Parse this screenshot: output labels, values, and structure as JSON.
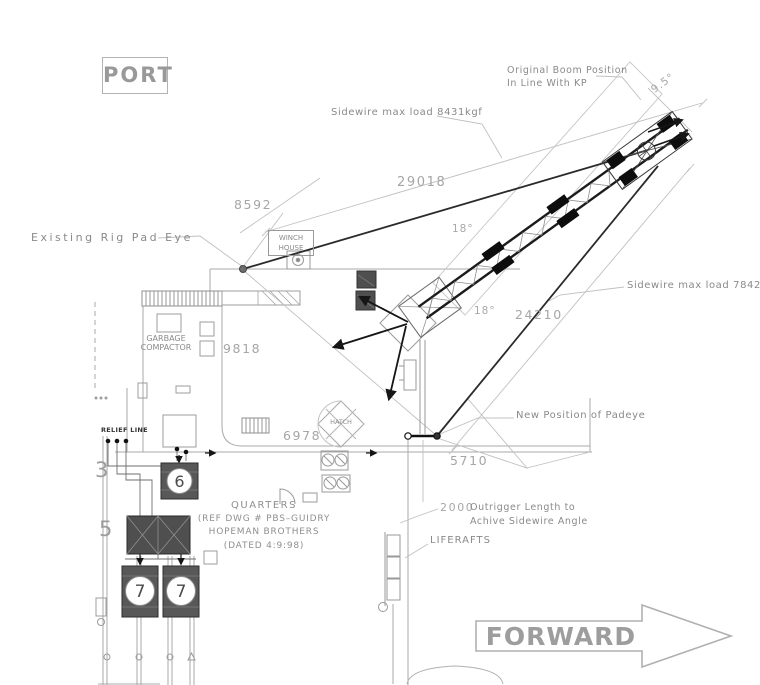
{
  "title": "Deck plan — crane boom and sidewire rigging arrangement",
  "orientation": {
    "port": "PORT",
    "forward": "FORWARD"
  },
  "labels": {
    "original_boom_line1": "Original Boom Position",
    "original_boom_line2": "In Line With KP",
    "sidewire_upper": "Sidewire max load 8431kgf",
    "sidewire_lower": "Sidewire max load 7842kgf",
    "existing_pad_eye": "Existing Rig Pad Eye",
    "new_padeye": "New Position of Padeye",
    "winch_line1": "WINCH",
    "winch_line2": "HOUSE",
    "garbage_line1": "GARBAGE",
    "garbage_line2": "COMPACTOR",
    "hatch": "HATCH",
    "liferafts": "LIFERAFTS",
    "relief_line": "RELIEF LINE",
    "quarters_line1": "QUARTERS",
    "quarters_line2": "(REF  DWG  #  PBS–GUIDRY",
    "quarters_line3": "HOPEMAN  BROTHERS",
    "quarters_line4": "(DATED  4:9:98)",
    "outrigger_dim": "2000",
    "outrigger_note1": "Outrigger Length to",
    "outrigger_note2": "Achive Sidewire Angle"
  },
  "dimensions": {
    "boom_offset_angle": "9.5°",
    "sidewire_angle_upper": "18°",
    "sidewire_angle_lower": "18°",
    "dist_29018": "29018",
    "dist_8592": "8592",
    "dist_9818": "9818",
    "dist_6978": "6978",
    "dist_5710": "5710",
    "dist_24210": "24210"
  },
  "equipment_numbers": {
    "n3": "3",
    "n5": "5",
    "n6": "6",
    "n7_left": "7",
    "n7_right": "7"
  },
  "colors": {
    "line_light": "#bcbcbc",
    "line_mid": "#9a9a9a",
    "ink_dark": "#1a1a1a",
    "text_gray": "#8a8a8a",
    "dim_gray": "#a6a6a6",
    "equipment_fill": "#565656",
    "background": "#ffffff"
  }
}
